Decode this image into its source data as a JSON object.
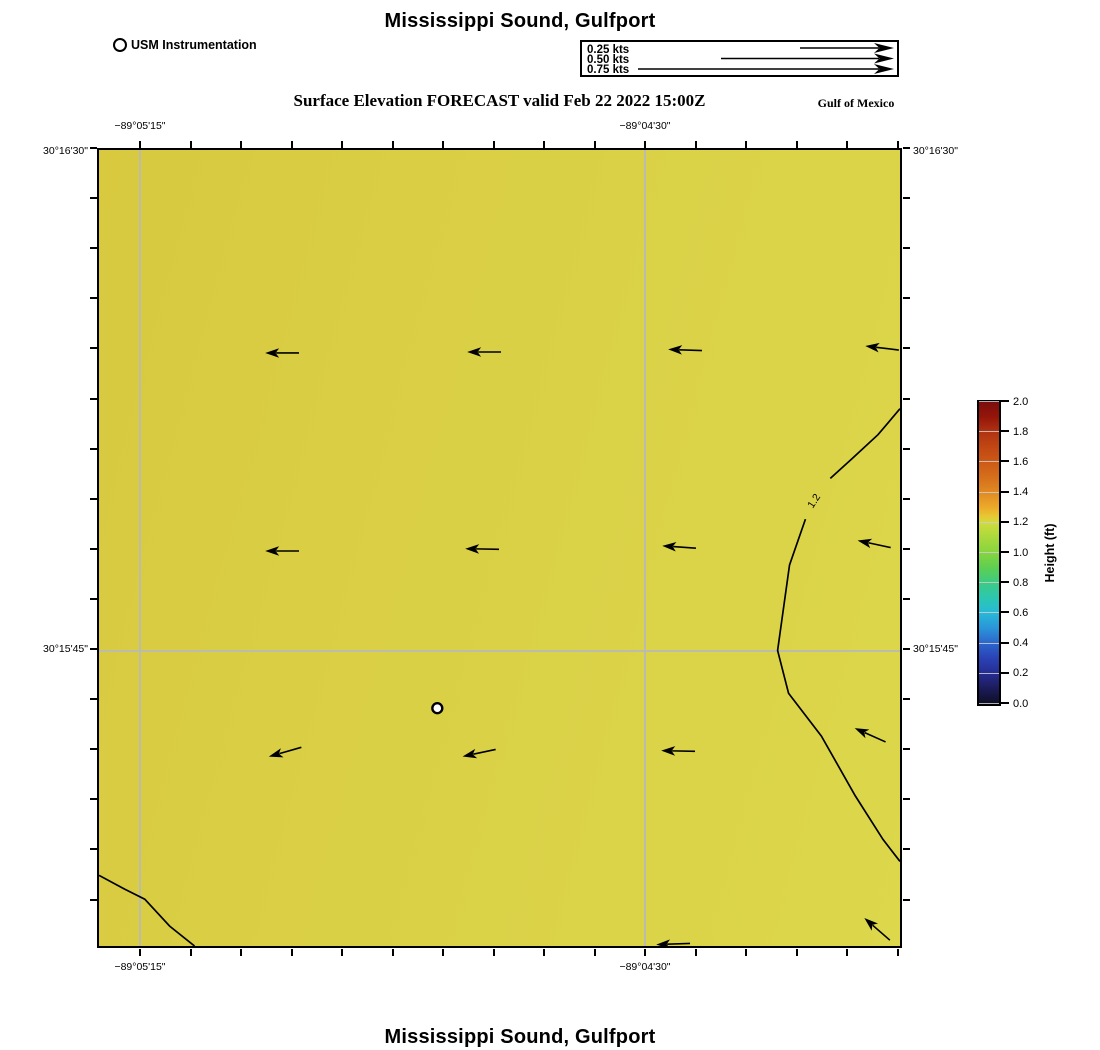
{
  "header": {
    "title": "Mississippi Sound, Gulfport",
    "station_legend_label": "USM Instrumentation",
    "subtitle": "Surface Elevation FORECAST valid Feb 22 2022 15:00Z",
    "region_label": "Gulf of Mexico"
  },
  "footer": {
    "title": "Mississippi Sound, Gulfport"
  },
  "speed_legend": {
    "rows": [
      {
        "label": "0.25 kts",
        "shaft_start": 218
      },
      {
        "label": "0.50 kts",
        "shaft_start": 139
      },
      {
        "label": "0.75 kts",
        "shaft_start": 56
      }
    ]
  },
  "chart_data": {
    "type": "heatmap",
    "title": "Mississippi Sound, Gulfport",
    "subtitle": "Surface Elevation FORECAST valid Feb 22 2022 15:00Z",
    "field": "surface_elevation_ft",
    "value_summary": "Nearly uniform surface elevation of about 1.1 to 1.25 ft across the domain; 1.2 ft contour arcs along the eastern edge and clips the southwest corner; weak westward currents under 0.25 kts",
    "x_range_deg": [
      -89.0886,
      -89.0686
    ],
    "y_range_deg": [
      30.255,
      30.275
    ],
    "x_axis": {
      "labels": [
        {
          "text": "−89°05'15\"",
          "x": 140
        },
        {
          "text": "−89°04'30\"",
          "x": 645
        }
      ]
    },
    "y_axis": {
      "labels": [
        {
          "text": "30°16'30\"",
          "y": 148
        },
        {
          "text": "30°15'45\"",
          "y": 649
        }
      ]
    },
    "grid": {
      "vertical_x": [
        138,
        643
      ],
      "horizontal_y": [
        649
      ]
    },
    "station": {
      "x": 340,
      "y": 561,
      "name": "USM Instrumentation"
    },
    "contours": [
      {
        "level": "1.2",
        "label": {
          "x": 719,
          "y": 353,
          "rotate": -57
        },
        "segments": [
          [
            [
              805,
              260
            ],
            [
              783,
              286
            ],
            [
              757,
              310
            ],
            [
              735,
              330
            ]
          ],
          [
            [
              710,
              371
            ],
            [
              694,
              417
            ],
            [
              682,
              503
            ],
            [
              693,
              546
            ],
            [
              726,
              589
            ],
            [
              760,
              649
            ],
            [
              788,
              693
            ],
            [
              805,
              715
            ]
          ]
        ]
      },
      {
        "level": "1.2",
        "label": null,
        "segments": [
          [
            [
              0,
              729
            ],
            [
              26,
              743
            ],
            [
              46,
              753
            ],
            [
              71,
              780
            ],
            [
              96,
              800
            ]
          ]
        ]
      }
    ],
    "vectors": [
      {
        "x": 281,
        "y": 352,
        "angle": 180
      },
      {
        "x": 484,
        "y": 351,
        "angle": 180
      },
      {
        "x": 686,
        "y": 349,
        "angle": 182
      },
      {
        "x": 884,
        "y": 347,
        "angle": 187
      },
      {
        "x": 281,
        "y": 551,
        "angle": 180
      },
      {
        "x": 482,
        "y": 549,
        "angle": 181
      },
      {
        "x": 680,
        "y": 547,
        "angle": 184
      },
      {
        "x": 876,
        "y": 544,
        "angle": 192
      },
      {
        "x": 284,
        "y": 753,
        "angle": 164
      },
      {
        "x": 479,
        "y": 754,
        "angle": 168
      },
      {
        "x": 679,
        "y": 752,
        "angle": 181
      },
      {
        "x": 872,
        "y": 736,
        "angle": 204
      },
      {
        "x": 674,
        "y": 946,
        "angle": 178
      },
      {
        "x": 879,
        "y": 931,
        "angle": 221
      }
    ],
    "colorbar": {
      "label": "Height (ft)",
      "ticks": [
        "2.0",
        "1.8",
        "1.6",
        "1.4",
        "1.2",
        "1.0",
        "0.8",
        "0.6",
        "0.4",
        "0.2",
        "0.0"
      ],
      "stops": [
        {
          "pos": 0.0,
          "color": "#7a0e0c"
        },
        {
          "pos": 0.05,
          "color": "#96150a"
        },
        {
          "pos": 0.1,
          "color": "#b03312"
        },
        {
          "pos": 0.15,
          "color": "#c14713"
        },
        {
          "pos": 0.2,
          "color": "#cc5a16"
        },
        {
          "pos": 0.25,
          "color": "#d66f1c"
        },
        {
          "pos": 0.3,
          "color": "#e08a22"
        },
        {
          "pos": 0.35,
          "color": "#ecab2a"
        },
        {
          "pos": 0.38,
          "color": "#e6c934"
        },
        {
          "pos": 0.4,
          "color": "#cfdb3c"
        },
        {
          "pos": 0.45,
          "color": "#a8d93d"
        },
        {
          "pos": 0.5,
          "color": "#86d43e"
        },
        {
          "pos": 0.55,
          "color": "#5ccf53"
        },
        {
          "pos": 0.6,
          "color": "#3bca85"
        },
        {
          "pos": 0.65,
          "color": "#2cc7b2"
        },
        {
          "pos": 0.7,
          "color": "#27b8d8"
        },
        {
          "pos": 0.75,
          "color": "#2b93d8"
        },
        {
          "pos": 0.8,
          "color": "#2c64cc"
        },
        {
          "pos": 0.85,
          "color": "#2a41b4"
        },
        {
          "pos": 0.9,
          "color": "#262c90"
        },
        {
          "pos": 0.95,
          "color": "#1b1b58"
        },
        {
          "pos": 1.0,
          "color": "#0e0e24"
        }
      ]
    }
  }
}
